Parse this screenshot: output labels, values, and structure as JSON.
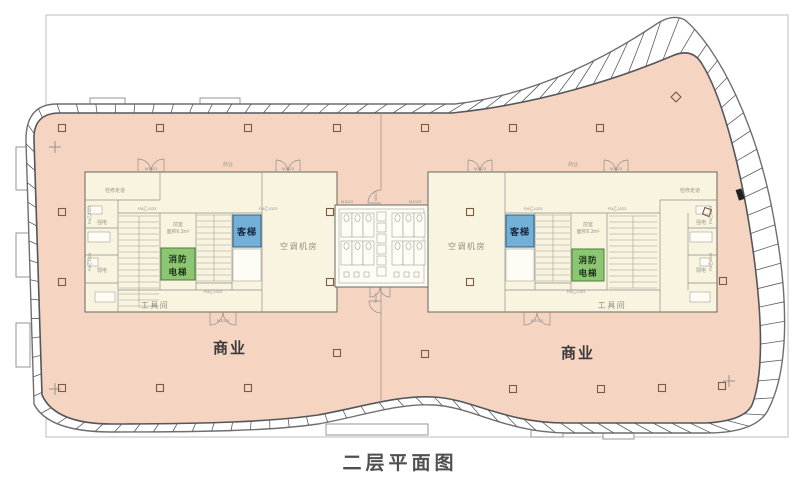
{
  "title": "二层平面图",
  "zones": {
    "commercial_left": "商业",
    "commercial_right": "商业",
    "commercial_small_left": "商业",
    "commercial_small_right": "商业"
  },
  "core": {
    "passenger_lift": "客梯",
    "fire_lift_line1": "消防",
    "fire_lift_line2": "电梯",
    "ac_room": "空调机房",
    "tool_room": "工具间",
    "vestibule": "前室",
    "vestibule_area": "面积6.3m²",
    "service_corridor": "检修走道",
    "strong_power": "强电",
    "weak_power": "弱电"
  },
  "door_tags": {
    "main": "M1023",
    "fire": "FM乙1023",
    "side": "M823"
  },
  "colors": {
    "floor_pink": "#f5d5c1",
    "core_cream": "#f9f4e0",
    "lift_blue": "#72b0d7",
    "lift_green": "#8cc672"
  },
  "columns": [
    [
      62,
      128
    ],
    [
      160,
      128
    ],
    [
      248,
      128
    ],
    [
      337,
      128
    ],
    [
      425,
      128
    ],
    [
      513,
      128
    ],
    [
      600,
      128
    ],
    [
      676,
      97,
      45
    ],
    [
      62,
      212
    ],
    [
      330,
      212
    ],
    [
      470,
      212
    ],
    [
      707,
      212,
      20
    ],
    [
      62,
      282
    ],
    [
      330,
      282
    ],
    [
      470,
      282
    ],
    [
      723,
      281
    ],
    [
      337,
      353
    ],
    [
      425,
      354
    ],
    [
      62,
      388
    ],
    [
      160,
      388
    ],
    [
      248,
      388
    ],
    [
      513,
      389
    ],
    [
      601,
      389
    ],
    [
      662,
      388
    ],
    [
      722,
      386
    ]
  ],
  "crosses": [
    [
      55,
      147
    ],
    [
      55,
      389
    ],
    [
      729,
      381
    ]
  ]
}
